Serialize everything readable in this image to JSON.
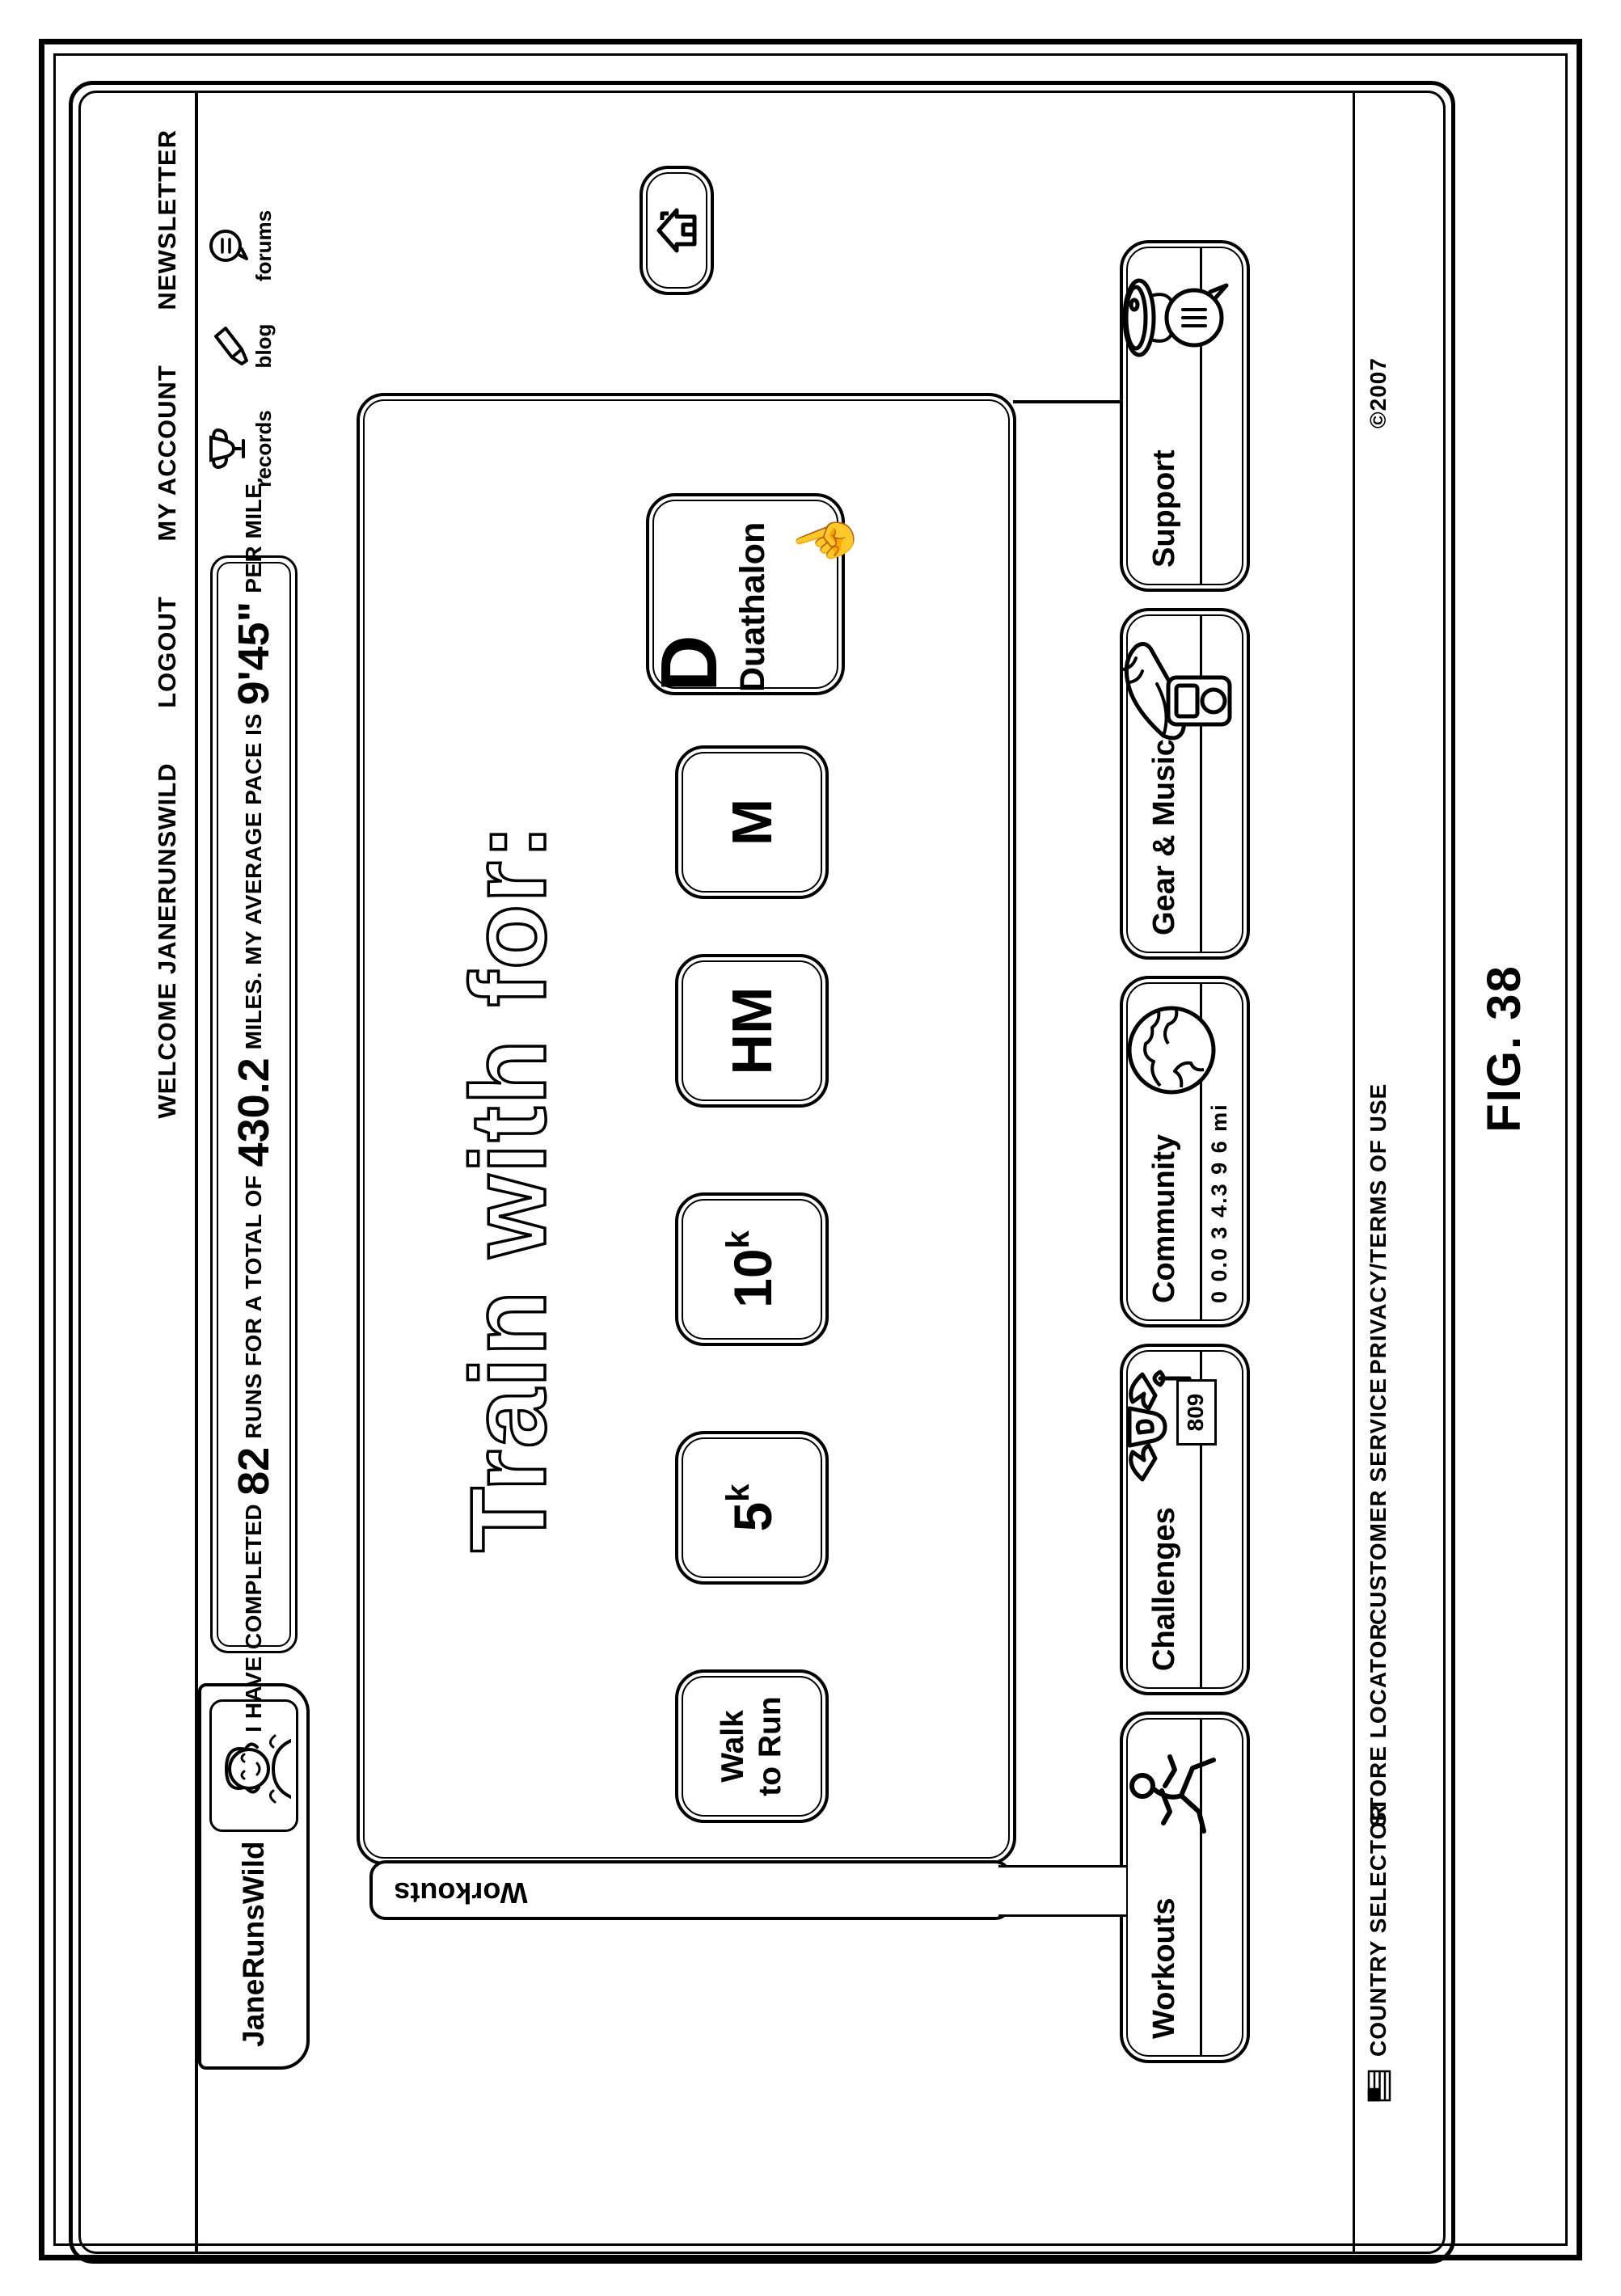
{
  "figure_label": "FIG. 38",
  "header": {
    "welcome": "WELCOME JANERUNSWILD",
    "logout": "LOGOUT",
    "my_account": "MY ACCOUNT",
    "newsletter": "NEWSLETTER"
  },
  "user_tab": {
    "username": "JaneRunsWild"
  },
  "stats": {
    "prefix": "I HAVE COMPLETED",
    "runs": "82",
    "mid1": "RUNS FOR A TOTAL OF",
    "miles": "430.2",
    "mid2": "MILES. MY AVERAGE PACE IS",
    "pace": "9'45\"",
    "suffix": "PER MILE."
  },
  "quick_links": {
    "records": "records",
    "blog": "blog",
    "forums": "forums"
  },
  "panel": {
    "tab_label": "Workouts",
    "heading": "Train with for:",
    "btn_walk": {
      "line1": "Walk",
      "line2": "to Run"
    },
    "btn_5k": {
      "base": "5",
      "sup": "k"
    },
    "btn_10k": {
      "base": "10",
      "sup": "k"
    },
    "btn_hm": {
      "label": "HM"
    },
    "btn_m": {
      "label": "M"
    },
    "btn_d": {
      "initial": "D",
      "label": "Duathalon"
    }
  },
  "nav": {
    "workouts": {
      "label": "Workouts"
    },
    "challenges": {
      "label": "Challenges",
      "badge": "809"
    },
    "community": {
      "label": "Community",
      "odometer": "0 0.0 3 4.3 9 6 mi"
    },
    "gear": {
      "label": "Gear & Music"
    },
    "support": {
      "label": "Support"
    }
  },
  "footer": {
    "country_selector": "COUNTRY SELECTOR",
    "store_locator": "STORE LOCATOR",
    "customer_service": "CUSTOMER SERVICE",
    "privacy": "PRIVACY/TERMS OF USE",
    "copyright": "©2007"
  },
  "colors": {
    "ink": "#000000",
    "paper": "#ffffff"
  }
}
